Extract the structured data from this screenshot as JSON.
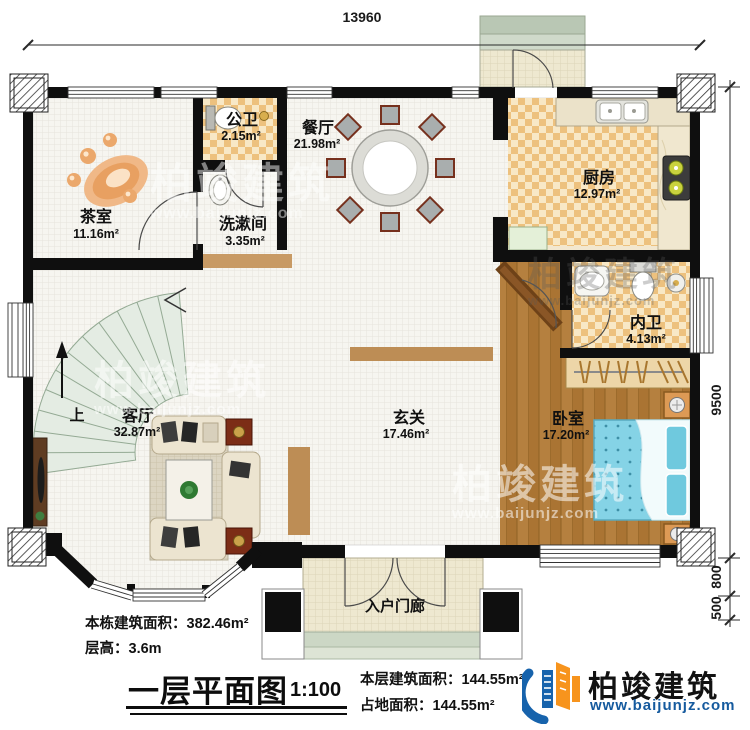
{
  "drawing": {
    "top_dimension": "13960",
    "right_dimensions": [
      "9500",
      "800",
      "500"
    ]
  },
  "rooms": {
    "tea_room": {
      "name": "茶室",
      "area": "11.16m²"
    },
    "public_bath": {
      "name": "公卫",
      "area": "2.15m²"
    },
    "washroom": {
      "name": "洗漱间",
      "area": "3.35m²"
    },
    "dining": {
      "name": "餐厅",
      "area": "21.98m²"
    },
    "kitchen": {
      "name": "厨房",
      "area": "12.97m²"
    },
    "inner_bath": {
      "name": "内卫",
      "area": "4.13m²"
    },
    "bedroom": {
      "name": "卧室",
      "area": "17.20m²"
    },
    "foyer": {
      "name": "玄关",
      "area": "17.46m²"
    },
    "living": {
      "name": "客厅",
      "area": "32.87m²"
    },
    "porch": {
      "name": "入户门廊"
    }
  },
  "stairs": {
    "up_label": "上"
  },
  "title_block": {
    "building_area": "本栋建筑面积：382.46m²",
    "floor_height": "层高：3.6m",
    "title": "一层平面图",
    "scale": "1:100",
    "floor_area": "本层建筑面积：144.55m²",
    "footprint": "占地面积：144.55m²"
  },
  "brand": {
    "name": "柏竣建筑",
    "url": "www.baijunjz.com"
  },
  "watermark": {
    "text": "柏竣建筑",
    "url": "www.baijunjz.com"
  },
  "colors": {
    "wall": "#0f0f0f",
    "wood": "#b07c3e",
    "checker": "#edc17e",
    "accent_blue": "#1763ac",
    "accent_orange": "#f7941d"
  }
}
